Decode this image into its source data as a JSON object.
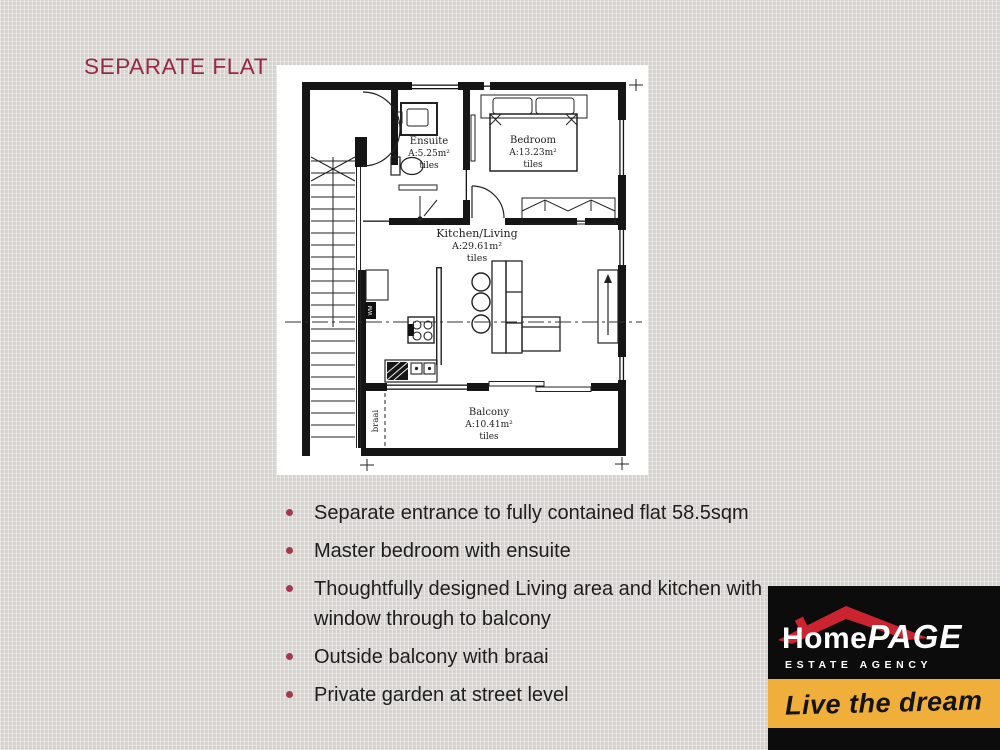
{
  "slide": {
    "title": "SEPARATE FLAT",
    "bullets": [
      "Separate entrance to fully contained flat 58.5sqm",
      "Master bedroom with ensuite",
      "Thoughtfully designed Living area and kitchen with window through to balcony",
      "Outside balcony with braai",
      "Private garden at street level"
    ]
  },
  "floorplan": {
    "rooms": [
      {
        "name": "Ensuite",
        "area": "A:5.25m²",
        "floor": "tiles"
      },
      {
        "name": "Bedroom",
        "area": "A:13.23m²",
        "floor": "tiles"
      },
      {
        "name": "Kitchen/Living",
        "area": "A:29.61m²",
        "floor": "tiles"
      },
      {
        "name": "Balcony",
        "area": "A:10.41m²",
        "floor": "tiles"
      }
    ],
    "labels": {
      "wm": "WM",
      "braai": "braai"
    }
  },
  "logo": {
    "brand_home": "Home",
    "brand_page": "PAGE",
    "subtitle": "ESTATE AGENCY",
    "tagline": "Live the dream",
    "colors": {
      "roof_red": "#cb2430",
      "band_yellow": "#f0ae3b",
      "background": "#0c0c0c"
    }
  },
  "colors": {
    "page_background": "#d7d4d0",
    "title_red": "#972942",
    "bullet_dot": "#a23a4e",
    "body_text": "#1e1e1e",
    "plan_ink": "#222222"
  }
}
